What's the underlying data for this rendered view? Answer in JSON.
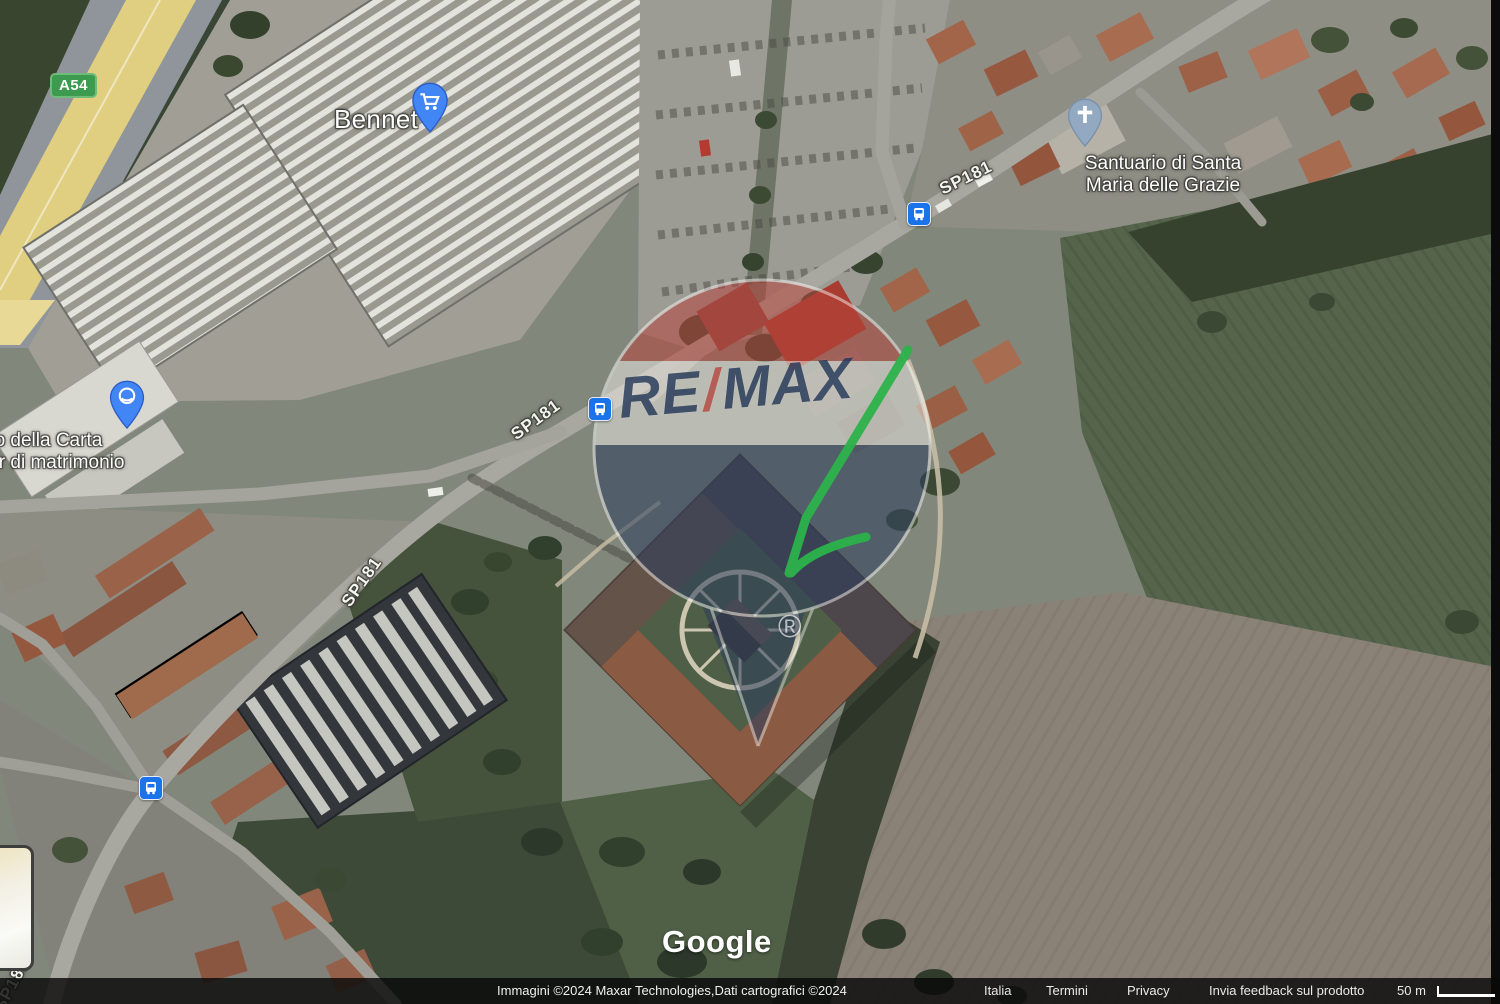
{
  "watermark": {
    "re": "RE",
    "slash": "/",
    "max": "MAX",
    "registered": "®"
  },
  "poi": {
    "bennet": {
      "label": "Bennet"
    },
    "santuario": {
      "line1": "Santuario di Santa",
      "line2": "Maria delle Grazie"
    },
    "carta": {
      "line1": "do della Carta",
      "line2": "nir di matrimonio"
    }
  },
  "roads": {
    "sp181": "SP181",
    "a54": "A54"
  },
  "branding": {
    "google": "Google"
  },
  "attribution": {
    "credit": "Immagini ©2024 Maxar Technologies,Dati cartografici ©2024",
    "country": "Italia",
    "terms": "Termini",
    "privacy": "Privacy",
    "feedback": "Invia feedback sul prodotto",
    "scale": "50 m"
  },
  "icons": {
    "bus": "bus-stop-icon",
    "cart": "shopping-cart-icon",
    "church": "church-cross-icon",
    "pin": "map-pin-icon"
  },
  "colors": {
    "arrow_green": "#2cb24b",
    "poi_pin_blue": "#4285f4",
    "church_pin_blue": "#93a9c1",
    "transit_blue": "#1a73e8",
    "shield_green": "#3d9b4f",
    "remax_red": "#b5443c",
    "remax_blue": "#2b3d5c",
    "remax_text": "#1e3254"
  }
}
